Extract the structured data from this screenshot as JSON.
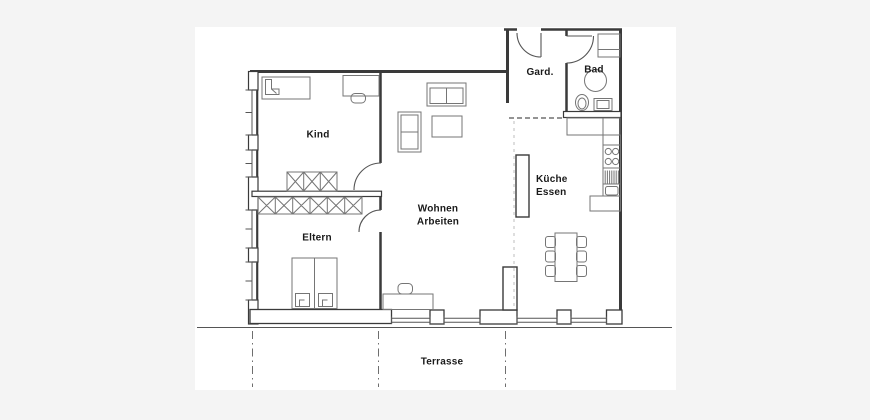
{
  "plan": {
    "rooms": {
      "kind": {
        "label": "Kind"
      },
      "eltern": {
        "label": "Eltern"
      },
      "wohnen_arbeiten": {
        "line1": "Wohnen",
        "line2": "Arbeiten"
      },
      "kueche_essen": {
        "line1": "Küche",
        "line2": "Essen"
      },
      "garderobe": {
        "label": "Gard."
      },
      "bad": {
        "label": "Bad"
      },
      "terrasse": {
        "label": "Terrasse"
      }
    },
    "colors": {
      "page_background": "#f4f4f4",
      "paper": "#ffffff",
      "wall_line": "#3a3a3a",
      "furniture_line": "#757575",
      "door_line": "#555555",
      "label_text": "#1a1a1a"
    }
  }
}
